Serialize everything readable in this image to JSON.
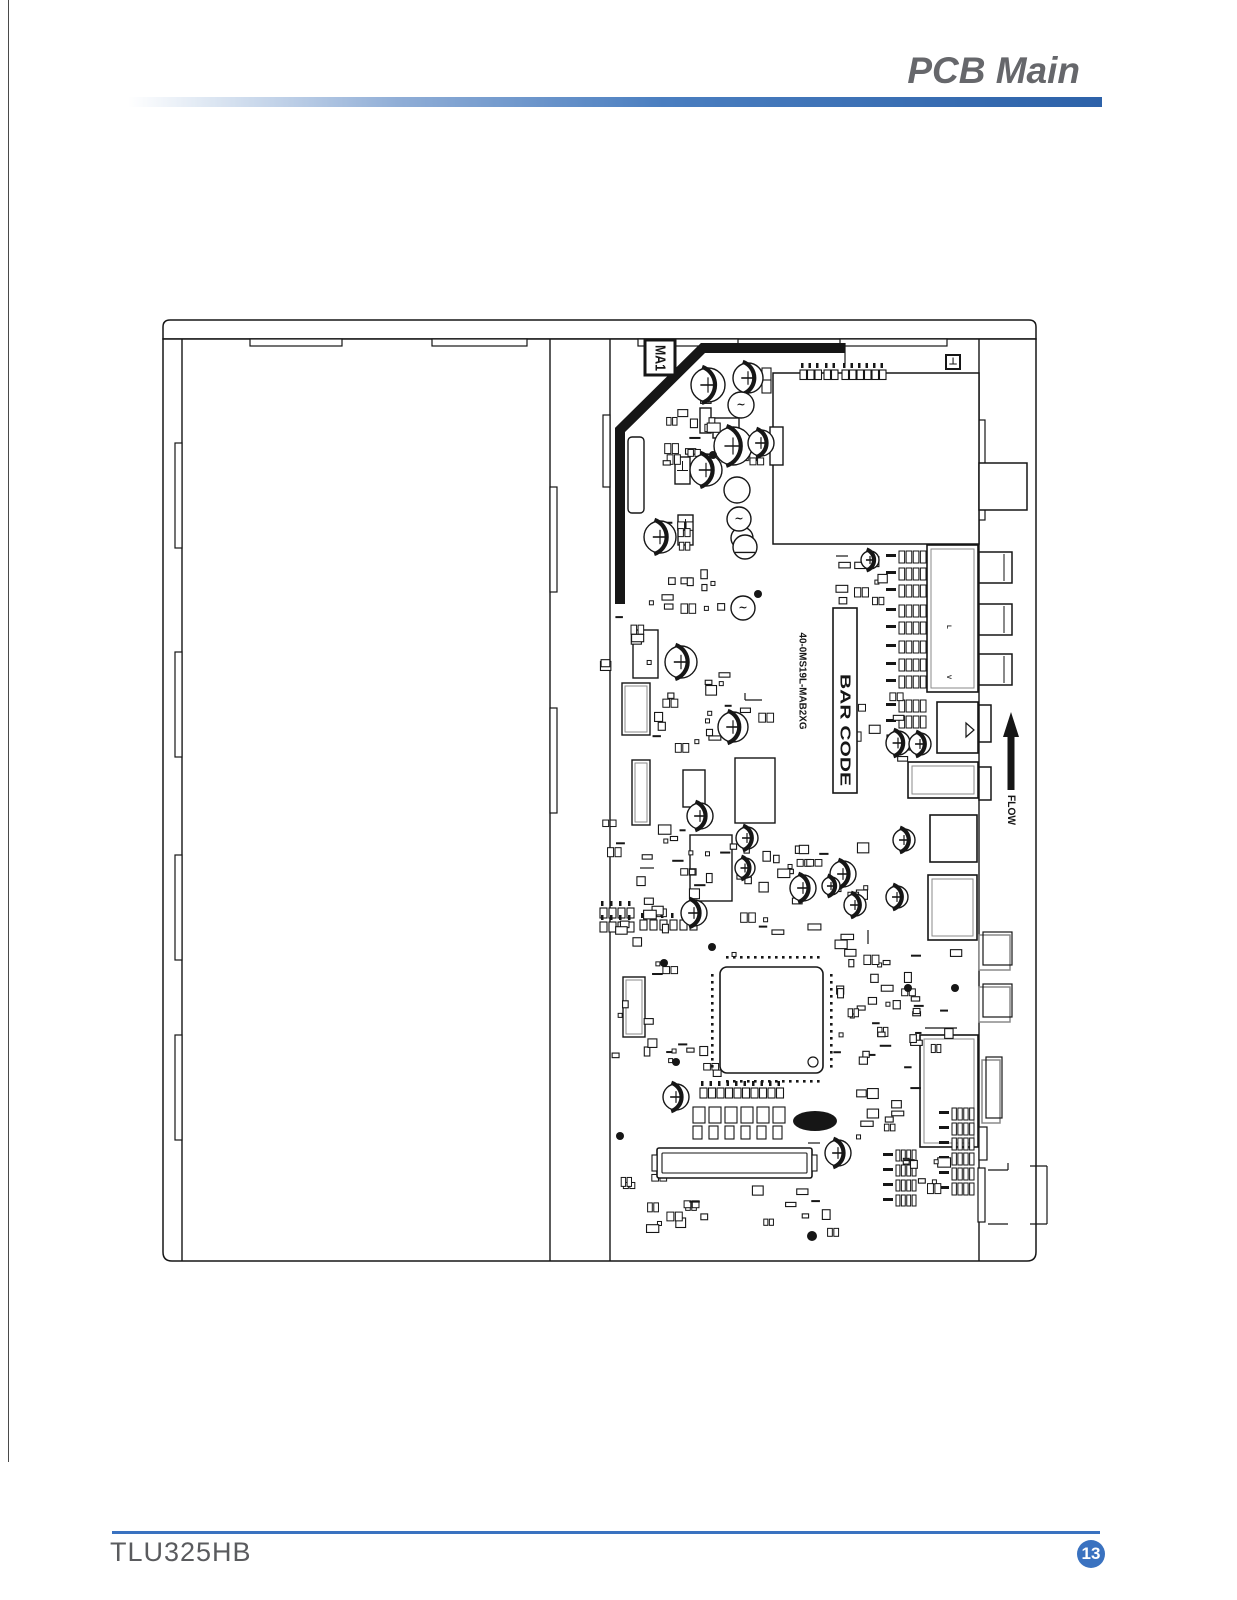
{
  "page": {
    "header": {
      "title": "PCB Main"
    },
    "footer": {
      "model": "TLU325HB",
      "page_number": "13"
    }
  },
  "colors": {
    "accent_blue": "#3a72c0",
    "bar_blue_dark": "#2d62a9",
    "title_gray": "#66676b",
    "model_gray": "#5a5b5e",
    "line_black": "#161616",
    "connector_gray": "#8a8a8a"
  },
  "board": {
    "labels": {
      "board_ref": "MA1",
      "part_number": "40-0MS19L-MAB2XG",
      "barcode": "BAR CODE",
      "flow": "FLOW",
      "marker": "⊥",
      "crystal_ref": "Y1",
      "jack_left": "L",
      "jack_video": "V"
    },
    "structure": {
      "band": {
        "x": 163,
        "y": 320,
        "w": 873,
        "h": 19,
        "r": 7
      },
      "body": {
        "x": 163,
        "y": 339,
        "w": 873,
        "h": 922,
        "r": 9
      },
      "panel_lines": [
        182,
        550,
        610,
        979
      ],
      "top_tabs": [
        [
          250,
          339,
          92,
          7
        ],
        [
          432,
          339,
          95,
          7
        ],
        [
          638,
          339,
          100,
          7
        ],
        [
          840,
          339,
          107,
          7
        ]
      ],
      "left_tabs": [
        [
          175,
          443,
          7,
          105
        ],
        [
          175,
          652,
          7,
          105
        ],
        [
          175,
          855,
          7,
          105
        ],
        [
          175,
          1035,
          7,
          105
        ]
      ],
      "mid_tabs": [
        [
          550,
          487,
          7,
          105
        ],
        [
          550,
          708,
          7,
          105
        ],
        [
          603,
          415,
          7,
          72
        ]
      ],
      "edge_tabs": [
        [
          979,
          420,
          6,
          100
        ],
        [
          979,
          1127,
          8,
          33
        ],
        [
          978,
          1168,
          7,
          54
        ]
      ]
    },
    "heatsink": {
      "points": "845,348 703,348 620,430 620,604",
      "width": 10
    },
    "ma1_box": {
      "x": 645,
      "y": 340,
      "w": 30,
      "h": 35
    },
    "marker_box": {
      "x": 946,
      "y": 355,
      "w": 14,
      "h": 14
    },
    "tuner_shield": {
      "x": 773,
      "y": 373,
      "w": 206,
      "h": 171
    },
    "barcode_box": {
      "x": 833,
      "y": 608,
      "w": 24,
      "h": 185
    },
    "boxes": [
      {
        "x": 927,
        "y": 545,
        "w": 51,
        "h": 147,
        "d": 1
      },
      {
        "x": 937,
        "y": 702,
        "w": 41,
        "h": 51,
        "tri": 1
      },
      {
        "x": 908,
        "y": 762,
        "w": 70,
        "h": 36,
        "d": 1
      },
      {
        "x": 930,
        "y": 815,
        "w": 47,
        "h": 47
      },
      {
        "x": 928,
        "y": 875,
        "w": 49,
        "h": 65,
        "d": 1
      },
      {
        "x": 920,
        "y": 1035,
        "w": 58,
        "h": 112,
        "d": 1
      }
    ],
    "bumps": [
      {
        "x": 979,
        "y": 463,
        "w": 48,
        "h": 47
      },
      {
        "x": 979,
        "y": 552,
        "w": 33,
        "h": 31,
        "d": 1
      },
      {
        "x": 979,
        "y": 604,
        "w": 33,
        "h": 31,
        "d": 1
      },
      {
        "x": 979,
        "y": 654,
        "w": 33,
        "h": 31,
        "d": 1
      },
      {
        "x": 979,
        "y": 705,
        "w": 12,
        "h": 37
      },
      {
        "x": 979,
        "y": 767,
        "w": 12,
        "h": 33
      },
      {
        "x": 979,
        "y": 935,
        "w": 31,
        "h": 35,
        "g": 1
      },
      {
        "x": 979,
        "y": 987,
        "w": 31,
        "h": 35,
        "g": 1
      },
      {
        "x": 982,
        "y": 1060,
        "w": 18,
        "h": 63,
        "g": 1
      }
    ],
    "medium_rects": [
      {
        "x": 628,
        "y": 437,
        "w": 16,
        "h": 76,
        "r": 4
      },
      {
        "x": 700,
        "y": 408,
        "w": 11,
        "h": 25
      },
      {
        "x": 675,
        "y": 457,
        "w": 15,
        "h": 27
      },
      {
        "x": 678,
        "y": 515,
        "w": 15,
        "h": 30
      },
      {
        "x": 770,
        "y": 427,
        "w": 13,
        "h": 38
      },
      {
        "x": 713,
        "y": 418,
        "w": 26,
        "h": 20
      },
      {
        "x": 633,
        "y": 630,
        "w": 25,
        "h": 48
      },
      {
        "x": 622,
        "y": 683,
        "w": 28,
        "h": 52,
        "d": 1
      },
      {
        "x": 632,
        "y": 760,
        "w": 18,
        "h": 65,
        "d": 1
      },
      {
        "x": 683,
        "y": 770,
        "w": 22,
        "h": 37
      },
      {
        "x": 735,
        "y": 758,
        "w": 40,
        "h": 65
      },
      {
        "x": 690,
        "y": 835,
        "w": 42,
        "h": 66
      },
      {
        "x": 623,
        "y": 977,
        "w": 22,
        "h": 60,
        "d": 1
      }
    ],
    "main_ic": {
      "x": 720,
      "y": 967,
      "w": 103,
      "h": 106,
      "r": 7,
      "pin_dot": 2.6,
      "circle": [
        813,
        1062,
        5
      ]
    },
    "lvds": {
      "x": 657,
      "y": 1148,
      "w": 155,
      "h": 30
    },
    "crystal": {
      "cx": 815,
      "cy": 1121,
      "rx": 22,
      "ry": 10
    },
    "caps": [
      [
        708,
        385,
        17
      ],
      [
        748,
        378,
        15
      ],
      [
        733,
        446,
        19
      ],
      [
        761,
        443,
        13
      ],
      [
        706,
        470,
        16
      ],
      [
        660,
        537,
        16
      ],
      [
        681,
        662,
        16
      ],
      [
        733,
        727,
        15
      ],
      [
        700,
        816,
        13
      ],
      [
        747,
        838,
        11
      ],
      [
        694,
        913,
        13
      ],
      [
        898,
        743,
        12
      ],
      [
        920,
        744,
        11
      ],
      [
        904,
        840,
        11
      ],
      [
        803,
        888,
        13
      ],
      [
        843,
        874,
        13
      ],
      [
        855,
        905,
        11
      ],
      [
        897,
        897,
        11
      ],
      [
        831,
        886,
        9
      ],
      [
        676,
        1097,
        13
      ],
      [
        838,
        1153,
        13
      ],
      [
        745,
        868,
        10
      ],
      [
        870,
        560,
        9
      ]
    ],
    "plain_circles": [
      [
        737,
        490,
        13
      ],
      [
        742,
        538,
        11
      ]
    ],
    "coils": [
      [
        741,
        405,
        13
      ],
      [
        739,
        519,
        12
      ],
      [
        743,
        608,
        12
      ]
    ],
    "semis": [
      [
        745,
        547,
        12
      ]
    ],
    "dots": [
      [
        713,
        455,
        4
      ],
      [
        758,
        594,
        4
      ],
      [
        712,
        947,
        4
      ],
      [
        664,
        963,
        4
      ],
      [
        908,
        988,
        4
      ],
      [
        676,
        1062,
        4
      ],
      [
        790,
        1163,
        5
      ],
      [
        620,
        1136,
        4
      ],
      [
        812,
        1236,
        5
      ],
      [
        955,
        988,
        4
      ]
    ],
    "res_groups": [
      {
        "w": 27,
        "h": 12,
        "a": [
          [
            899,
            551
          ],
          [
            899,
            568
          ],
          [
            899,
            585
          ],
          [
            899,
            605
          ],
          [
            899,
            622
          ],
          [
            899,
            641
          ],
          [
            899,
            659
          ],
          [
            899,
            676
          ],
          [
            899,
            700
          ],
          [
            899,
            716
          ]
        ]
      },
      {
        "w": 22,
        "h": 12,
        "a": [
          [
            952,
            1108
          ],
          [
            952,
            1123
          ],
          [
            952,
            1138
          ],
          [
            952,
            1153
          ],
          [
            952,
            1168
          ],
          [
            952,
            1183
          ]
        ]
      },
      {
        "w": 20,
        "h": 11,
        "a": [
          [
            896,
            1150
          ],
          [
            896,
            1165
          ],
          [
            896,
            1180
          ],
          [
            896,
            1195
          ]
        ]
      }
    ],
    "headers": [
      {
        "x": 800,
        "y": 370,
        "n": 3,
        "s": 7.5,
        "z": 6.5
      },
      {
        "x": 824,
        "y": 370,
        "n": 2,
        "s": 7.5,
        "z": 6.5
      },
      {
        "x": 842,
        "y": 370,
        "n": 6,
        "s": 7.5,
        "z": 6.5
      },
      {
        "x": 600,
        "y": 908,
        "n": 4,
        "s": 9,
        "z": 7
      },
      {
        "x": 600,
        "y": 922,
        "n": 4,
        "s": 9,
        "z": 7
      },
      {
        "x": 640,
        "y": 920,
        "n": 6,
        "s": 10,
        "z": 7
      },
      {
        "x": 700,
        "y": 1088,
        "n": 10,
        "s": 8.5,
        "z": 7
      },
      {
        "x": 693,
        "y": 1107,
        "n": 6,
        "s": 16,
        "z": 12
      },
      {
        "x": 693,
        "y": 1126,
        "n": 6,
        "s": 16,
        "z": 9
      },
      {
        "x": 762,
        "y": 368,
        "n": 2,
        "s": 12,
        "z": 9,
        "v": 1
      }
    ],
    "clusters": [
      [
        662,
        392,
        48,
        78,
        12,
        1
      ],
      [
        690,
        420,
        60,
        40,
        8,
        2
      ],
      [
        648,
        518,
        40,
        60,
        8,
        3
      ],
      [
        660,
        558,
        70,
        50,
        8,
        4
      ],
      [
        598,
        600,
        55,
        70,
        8,
        5
      ],
      [
        652,
        688,
        70,
        60,
        10,
        6
      ],
      [
        600,
        820,
        95,
        85,
        16,
        7
      ],
      [
        700,
        840,
        175,
        115,
        34,
        8
      ],
      [
        610,
        905,
        55,
        150,
        16,
        9
      ],
      [
        836,
        548,
        42,
        50,
        10,
        10
      ],
      [
        838,
        690,
        70,
        70,
        12,
        11
      ],
      [
        830,
        940,
        125,
        115,
        26,
        12
      ],
      [
        856,
        1085,
        60,
        60,
        10,
        13
      ],
      [
        888,
        1140,
        55,
        60,
        8,
        14
      ],
      [
        612,
        1160,
        90,
        70,
        12,
        15
      ],
      [
        748,
        1185,
        90,
        45,
        8,
        16
      ],
      [
        660,
        1040,
        55,
        50,
        8,
        17
      ],
      [
        700,
        655,
        60,
        60,
        8,
        18
      ],
      [
        838,
        1000,
        80,
        70,
        14,
        19
      ]
    ],
    "stubs": [
      [
        988,
        1170,
        1008,
        1170
      ],
      [
        1008,
        1163,
        1008,
        1170
      ],
      [
        1030,
        1166,
        1047,
        1166
      ],
      [
        1047,
        1166,
        1047,
        1224
      ],
      [
        1030,
        1224,
        1047,
        1224
      ],
      [
        988,
        1224,
        1008,
        1224
      ],
      [
        836,
        556,
        848,
        556
      ],
      [
        745,
        700,
        762,
        700
      ],
      [
        745,
        693,
        745,
        700
      ],
      [
        868,
        930,
        868,
        944
      ],
      [
        640,
        868,
        654,
        868
      ],
      [
        808,
        1143,
        820,
        1143
      ],
      [
        845,
        343,
        845,
        364
      ],
      [
        925,
        1028,
        957,
        1028
      ]
    ],
    "flow_arrow": {
      "tip": [
        1011,
        712
      ],
      "head_w": 16,
      "head_l": 25,
      "shaft_w": 7,
      "tail_y": 790
    },
    "text_pos": {
      "ma1": [
        660,
        358,
        15
      ],
      "part_number": [
        802,
        681,
        10
      ],
      "barcode": [
        845,
        730,
        15
      ],
      "flow": [
        1011,
        810,
        11
      ],
      "y1": [
        621,
        563,
        6
      ],
      "jack_l": [
        948,
        627,
        6
      ],
      "jack_v": [
        948,
        677,
        6
      ],
      "marker": [
        953,
        362,
        10
      ]
    }
  }
}
